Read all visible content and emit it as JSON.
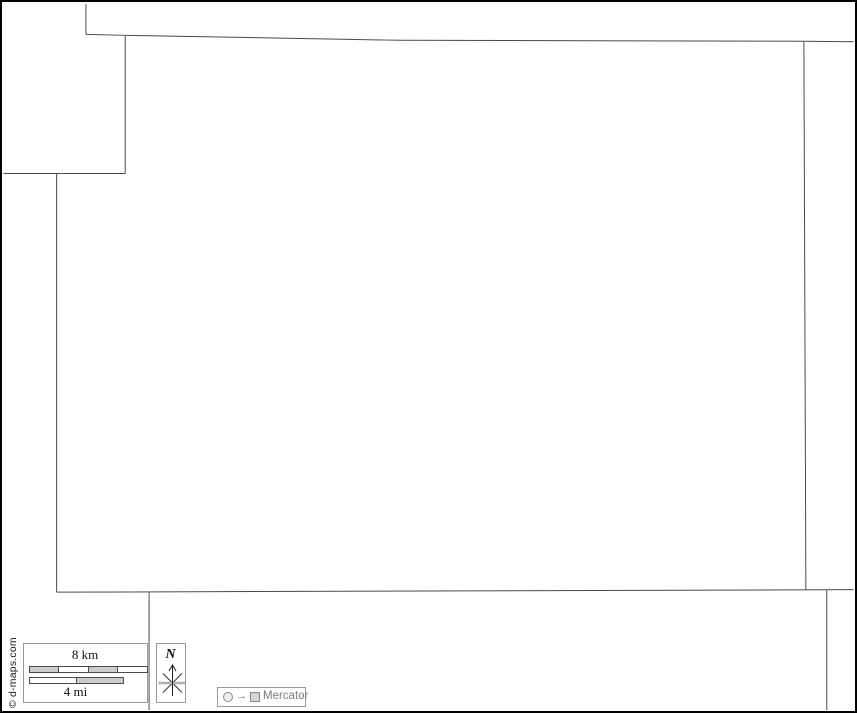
{
  "map": {
    "background": "#ffffff",
    "line_color": "#4a4a4a",
    "frame_color": "#000000",
    "lines": [
      {
        "name": "north-neighbor-divider-vertical",
        "points": [
          [
            84,
            2
          ],
          [
            84,
            32.5
          ]
        ]
      },
      {
        "name": "north-boundary",
        "points": [
          [
            84,
            32.5
          ],
          [
            123.5,
            33.5
          ],
          [
            400,
            38.5
          ],
          [
            806,
            39.5
          ],
          [
            856,
            40
          ]
        ]
      },
      {
        "name": "northwest-notch-vertical",
        "points": [
          [
            123.5,
            33.5
          ],
          [
            123.5,
            172.5
          ]
        ]
      },
      {
        "name": "northwest-notch-horizontal",
        "points": [
          [
            1,
            172.5
          ],
          [
            123.5,
            172.5
          ]
        ]
      },
      {
        "name": "west-boundary",
        "points": [
          [
            54.5,
            172.5
          ],
          [
            54.5,
            593.5
          ]
        ]
      },
      {
        "name": "south-boundary",
        "points": [
          [
            54.5,
            593.5
          ],
          [
            856,
            591
          ]
        ]
      },
      {
        "name": "east-boundary",
        "points": [
          [
            806,
            39.5
          ],
          [
            808,
            591.5
          ]
        ]
      },
      {
        "name": "south-neighbor-divider-left",
        "points": [
          [
            147.5,
            593
          ],
          [
            147.5,
            712
          ]
        ]
      },
      {
        "name": "south-neighbor-divider-right",
        "points": [
          [
            829,
            591.5
          ],
          [
            829,
            712
          ]
        ]
      }
    ]
  },
  "scale_bar": {
    "km_label": "8 km",
    "mi_label": "4 mi",
    "km_segment_colors": [
      "#cccccc",
      "#ffffff",
      "#cccccc",
      "#ffffff"
    ],
    "mi_segment_colors": [
      "#ffffff",
      "#cccccc"
    ]
  },
  "compass": {
    "label": "N"
  },
  "projection": {
    "arrow_glyph": "→",
    "label": "Mercator"
  },
  "copyright": "© d-maps.com"
}
